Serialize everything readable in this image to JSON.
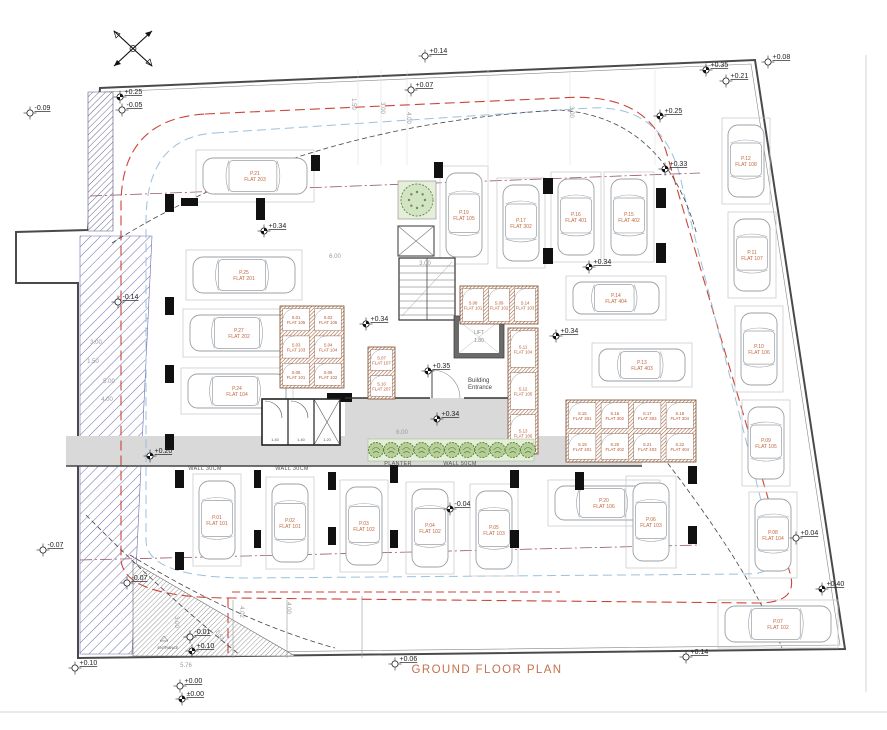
{
  "title": "GROUND FLOOR PLAN",
  "colors": {
    "accent_orange": "#c4714d",
    "label_orange": "#c0683f",
    "red_dash": "#cc4438",
    "blue_dash": "#9cc0de",
    "aisle_dash": "#96586a",
    "green_dark": "#57793f",
    "green_light": "#e4eed8",
    "bush_fill": "#b5cf96",
    "walkway_gray": "#d9d9d9",
    "boundary": "#4a4a4a",
    "hatch_blue": "#6b6bb0",
    "storage_wall": "#a2603c"
  },
  "labels": {
    "entrance_line1": "Building",
    "entrance_line2": "Entrance",
    "entrance_site": "ENTRANCE",
    "lift": "LIFT",
    "lift_dim": "1.80",
    "wall_150": "WALL 1.50"
  },
  "wall_labels": [
    {
      "x": 205,
      "y": 470,
      "t": "WALL 30CM"
    },
    {
      "x": 292,
      "y": 470,
      "t": "WALL 30CM"
    },
    {
      "x": 398,
      "y": 465,
      "t": "PLANTER"
    },
    {
      "x": 460,
      "y": 465,
      "t": "WALL 50CM"
    }
  ],
  "elevation_markers": [
    {
      "x": 120,
      "y": 97,
      "t": "+0.25",
      "f": true
    },
    {
      "x": 122,
      "y": 110,
      "t": "-0.05",
      "f": false
    },
    {
      "x": 30,
      "y": 113,
      "t": "-0.09",
      "f": false
    },
    {
      "x": 425,
      "y": 56,
      "t": "+0.14",
      "f": false
    },
    {
      "x": 411,
      "y": 90,
      "t": "+0.07",
      "f": false
    },
    {
      "x": 706,
      "y": 70,
      "t": "+0.35",
      "f": true
    },
    {
      "x": 726,
      "y": 81,
      "t": "+0.21",
      "f": false
    },
    {
      "x": 768,
      "y": 62,
      "t": "+0.08",
      "f": false
    },
    {
      "x": 660,
      "y": 116,
      "t": "+0.25",
      "f": true
    },
    {
      "x": 665,
      "y": 169,
      "t": "+0.33",
      "f": true
    },
    {
      "x": 264,
      "y": 231,
      "t": "+0.34",
      "f": true
    },
    {
      "x": 118,
      "y": 302,
      "t": "-0.14",
      "f": false
    },
    {
      "x": 366,
      "y": 324,
      "t": "+0.34",
      "f": true
    },
    {
      "x": 589,
      "y": 267,
      "t": "+0.34",
      "f": true
    },
    {
      "x": 556,
      "y": 336,
      "t": "+0.34",
      "f": true
    },
    {
      "x": 428,
      "y": 371,
      "t": "+0.35",
      "f": true
    },
    {
      "x": 437,
      "y": 419,
      "t": "+0.34",
      "f": true
    },
    {
      "x": 150,
      "y": 456,
      "t": "+0.20",
      "f": true
    },
    {
      "x": 450,
      "y": 509,
      "t": "-0.04",
      "f": true
    },
    {
      "x": 43,
      "y": 550,
      "t": "-0.07",
      "f": false
    },
    {
      "x": 127,
      "y": 583,
      "t": "-0.07",
      "f": false
    },
    {
      "x": 190,
      "y": 637,
      "t": "-0.01",
      "f": false
    },
    {
      "x": 192,
      "y": 651,
      "t": "+0.10",
      "f": true
    },
    {
      "x": 180,
      "y": 686,
      "t": "+0.00",
      "f": false
    },
    {
      "x": 182,
      "y": 699,
      "t": "±0.00",
      "f": true
    },
    {
      "x": 75,
      "y": 668,
      "t": "+0.10",
      "f": false
    },
    {
      "x": 395,
      "y": 664,
      "t": "+0.06",
      "f": false
    },
    {
      "x": 686,
      "y": 657,
      "t": "+0.14",
      "f": false
    },
    {
      "x": 796,
      "y": 538,
      "t": "+0.04",
      "f": false
    },
    {
      "x": 822,
      "y": 589,
      "t": "+0.40",
      "f": true
    }
  ],
  "parking": [
    {
      "x": 196,
      "y": 150,
      "w": 118,
      "h": 52,
      "d": "r",
      "p": "P.21",
      "f": "FLAT 203"
    },
    {
      "x": 186,
      "y": 250,
      "w": 116,
      "h": 50,
      "d": "r",
      "p": "P.25",
      "f": "FLAT 201"
    },
    {
      "x": 183,
      "y": 309,
      "w": 112,
      "h": 48,
      "d": "r",
      "p": "P.27",
      "f": "FLAT 202"
    },
    {
      "x": 181,
      "y": 368,
      "w": 112,
      "h": 46,
      "d": "r",
      "p": "P.24",
      "f": "FLAT 104"
    },
    {
      "x": 440,
      "y": 166,
      "w": 48,
      "h": 98,
      "d": "d",
      "p": "P.19",
      "f": "FLAT 105"
    },
    {
      "x": 497,
      "y": 178,
      "w": 48,
      "h": 90,
      "d": "d",
      "p": "P.17",
      "f": "FLAT 302"
    },
    {
      "x": 551,
      "y": 172,
      "w": 50,
      "h": 90,
      "d": "d",
      "p": "P.16",
      "f": "FLAT 401"
    },
    {
      "x": 604,
      "y": 172,
      "w": 50,
      "h": 90,
      "d": "d",
      "p": "P.15",
      "f": "FLAT 402"
    },
    {
      "x": 566,
      "y": 276,
      "w": 100,
      "h": 44,
      "d": "r",
      "p": "P.14",
      "f": "FLAT 404"
    },
    {
      "x": 592,
      "y": 343,
      "w": 100,
      "h": 44,
      "d": "r",
      "p": "P.13",
      "f": "FLAT 403"
    },
    {
      "x": 722,
      "y": 118,
      "w": 48,
      "h": 86,
      "d": "d",
      "p": "P.12",
      "f": "FLAT 108"
    },
    {
      "x": 728,
      "y": 212,
      "w": 48,
      "h": 86,
      "d": "d",
      "p": "P.11",
      "f": "FLAT 107"
    },
    {
      "x": 735,
      "y": 306,
      "w": 48,
      "h": 86,
      "d": "d",
      "p": "P.10",
      "f": "FLAT 106"
    },
    {
      "x": 742,
      "y": 400,
      "w": 48,
      "h": 86,
      "d": "d",
      "p": "P.09",
      "f": "FLAT 105"
    },
    {
      "x": 749,
      "y": 492,
      "w": 48,
      "h": 86,
      "d": "d",
      "p": "P.08",
      "f": "FLAT 104"
    },
    {
      "x": 718,
      "y": 600,
      "w": 120,
      "h": 48,
      "d": "r",
      "p": "P.07",
      "f": "FLAT 102"
    },
    {
      "x": 193,
      "y": 474,
      "w": 48,
      "h": 92,
      "d": "u",
      "p": "P.01",
      "f": "FLAT 101"
    },
    {
      "x": 266,
      "y": 477,
      "w": 48,
      "h": 92,
      "d": "u",
      "p": "P.02",
      "f": "FLAT 101"
    },
    {
      "x": 340,
      "y": 480,
      "w": 48,
      "h": 92,
      "d": "u",
      "p": "P.03",
      "f": "FLAT 102"
    },
    {
      "x": 406,
      "y": 482,
      "w": 48,
      "h": 92,
      "d": "u",
      "p": "P.04",
      "f": "FLAT 102"
    },
    {
      "x": 470,
      "y": 484,
      "w": 48,
      "h": 92,
      "d": "u",
      "p": "P.05",
      "f": "FLAT 103"
    },
    {
      "x": 548,
      "y": 480,
      "w": 112,
      "h": 46,
      "d": "r",
      "p": "P.20",
      "f": "FLAT 106"
    },
    {
      "x": 626,
      "y": 476,
      "w": 50,
      "h": 92,
      "d": "u",
      "p": "P.06",
      "f": "FLAT 103"
    }
  ],
  "storage_blocks": [
    {
      "x": 280,
      "y": 306,
      "cols": 2,
      "rows": 3,
      "w": 64,
      "h": 82,
      "rooms": [
        "S.01|FLAT 105",
        "S.02|FLAT 106",
        "S.03|FLAT 103",
        "S.04|FLAT 104",
        "S.05|FLAT 101",
        "S.06|FLAT 102"
      ]
    },
    {
      "x": 368,
      "y": 347,
      "cols": 1,
      "rows": 2,
      "w": 27,
      "h": 52,
      "rooms": [
        "S.07|FLAT 107",
        "S.10|FLAT 207"
      ]
    },
    {
      "x": 460,
      "y": 286,
      "cols": 3,
      "rows": 1,
      "w": 78,
      "h": 38,
      "rooms": [
        "S.08|FLAT 101",
        "S.09|FLAT 102",
        "S.14|FLAT 103"
      ]
    },
    {
      "x": 508,
      "y": 328,
      "cols": 1,
      "rows": 3,
      "w": 30,
      "h": 126,
      "rooms": [
        "S.11|FLAT 104",
        "S.12|FLAT 105",
        "S.13|FLAT 106"
      ]
    },
    {
      "x": 566,
      "y": 400,
      "cols": 4,
      "rows": 2,
      "w": 130,
      "h": 62,
      "rooms": [
        "S.15|FLAT 301",
        "S.16|FLAT 302",
        "S.17|FLAT 303",
        "S.18|FLAT 304",
        "S.19|FLAT 401",
        "S.20|FLAT 402",
        "S.21|FLAT 403",
        "S.22|FLAT 404"
      ]
    }
  ],
  "bins": {
    "x": 262,
    "y": 399,
    "w": 78,
    "h": 46,
    "dims": [
      "1.40",
      "1.40",
      "1.20"
    ]
  },
  "dim_labels": [
    {
      "x": 352,
      "y": 104,
      "t": "1.50",
      "r": 90
    },
    {
      "x": 381,
      "y": 108,
      "t": "3.00",
      "r": 90
    },
    {
      "x": 407,
      "y": 118,
      "t": "4.00",
      "r": 90
    },
    {
      "x": 570,
      "y": 112,
      "t": "3.00",
      "r": 90
    },
    {
      "x": 96,
      "y": 344,
      "t": "3.00",
      "r": 0
    },
    {
      "x": 93,
      "y": 363,
      "t": "1.50",
      "r": 0
    },
    {
      "x": 109,
      "y": 383,
      "t": "5.00",
      "r": 0
    },
    {
      "x": 107,
      "y": 401,
      "t": "4.00",
      "r": 0
    },
    {
      "x": 186,
      "y": 667,
      "t": "5.76",
      "r": 0
    },
    {
      "x": 175,
      "y": 622,
      "t": "3.00",
      "r": 90
    },
    {
      "x": 287,
      "y": 608,
      "t": "4.00",
      "r": 90
    },
    {
      "x": 240,
      "y": 612,
      "t": "4.02",
      "r": 90
    },
    {
      "x": 218,
      "y": 636,
      "t": "1.52",
      "r": 60
    },
    {
      "x": 425,
      "y": 265,
      "t": "3.00",
      "r": 0
    },
    {
      "x": 335,
      "y": 258,
      "t": "6.00",
      "r": 0
    },
    {
      "x": 402,
      "y": 434,
      "t": "6.00",
      "r": 0
    }
  ]
}
